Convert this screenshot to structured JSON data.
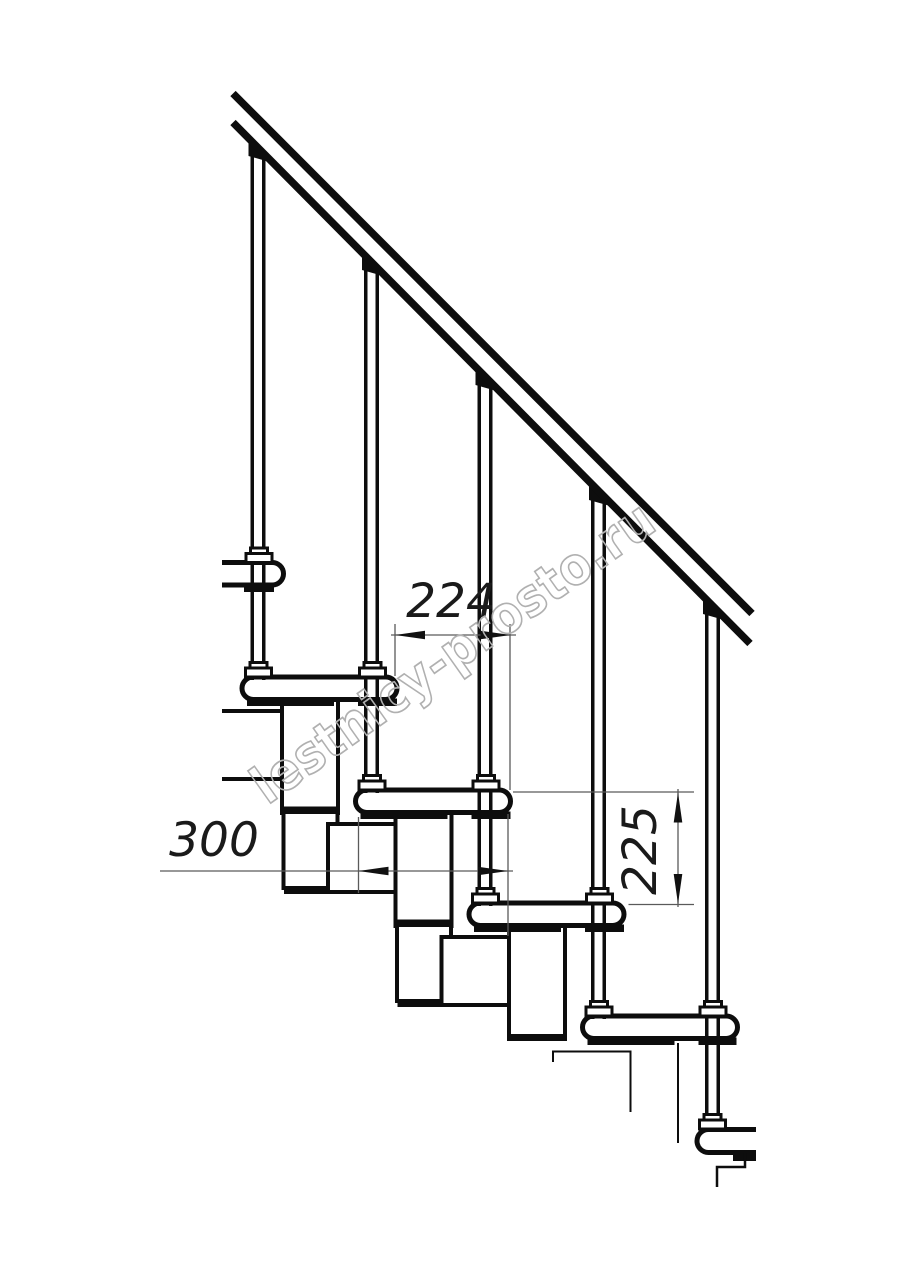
{
  "drawing": {
    "dimensions": {
      "step_run": {
        "value": "224"
      },
      "tread_depth": {
        "value": "300"
      },
      "step_rise": {
        "value": "225"
      }
    },
    "watermark": {
      "text": "lestnicy-prosto.ru"
    },
    "colors": {
      "line": "#0d0d0d",
      "dimension_line": "#5a5a5a",
      "dimension_text": "#1a1a1a",
      "watermark": "#b0b0b0",
      "background": "#ffffff"
    }
  }
}
